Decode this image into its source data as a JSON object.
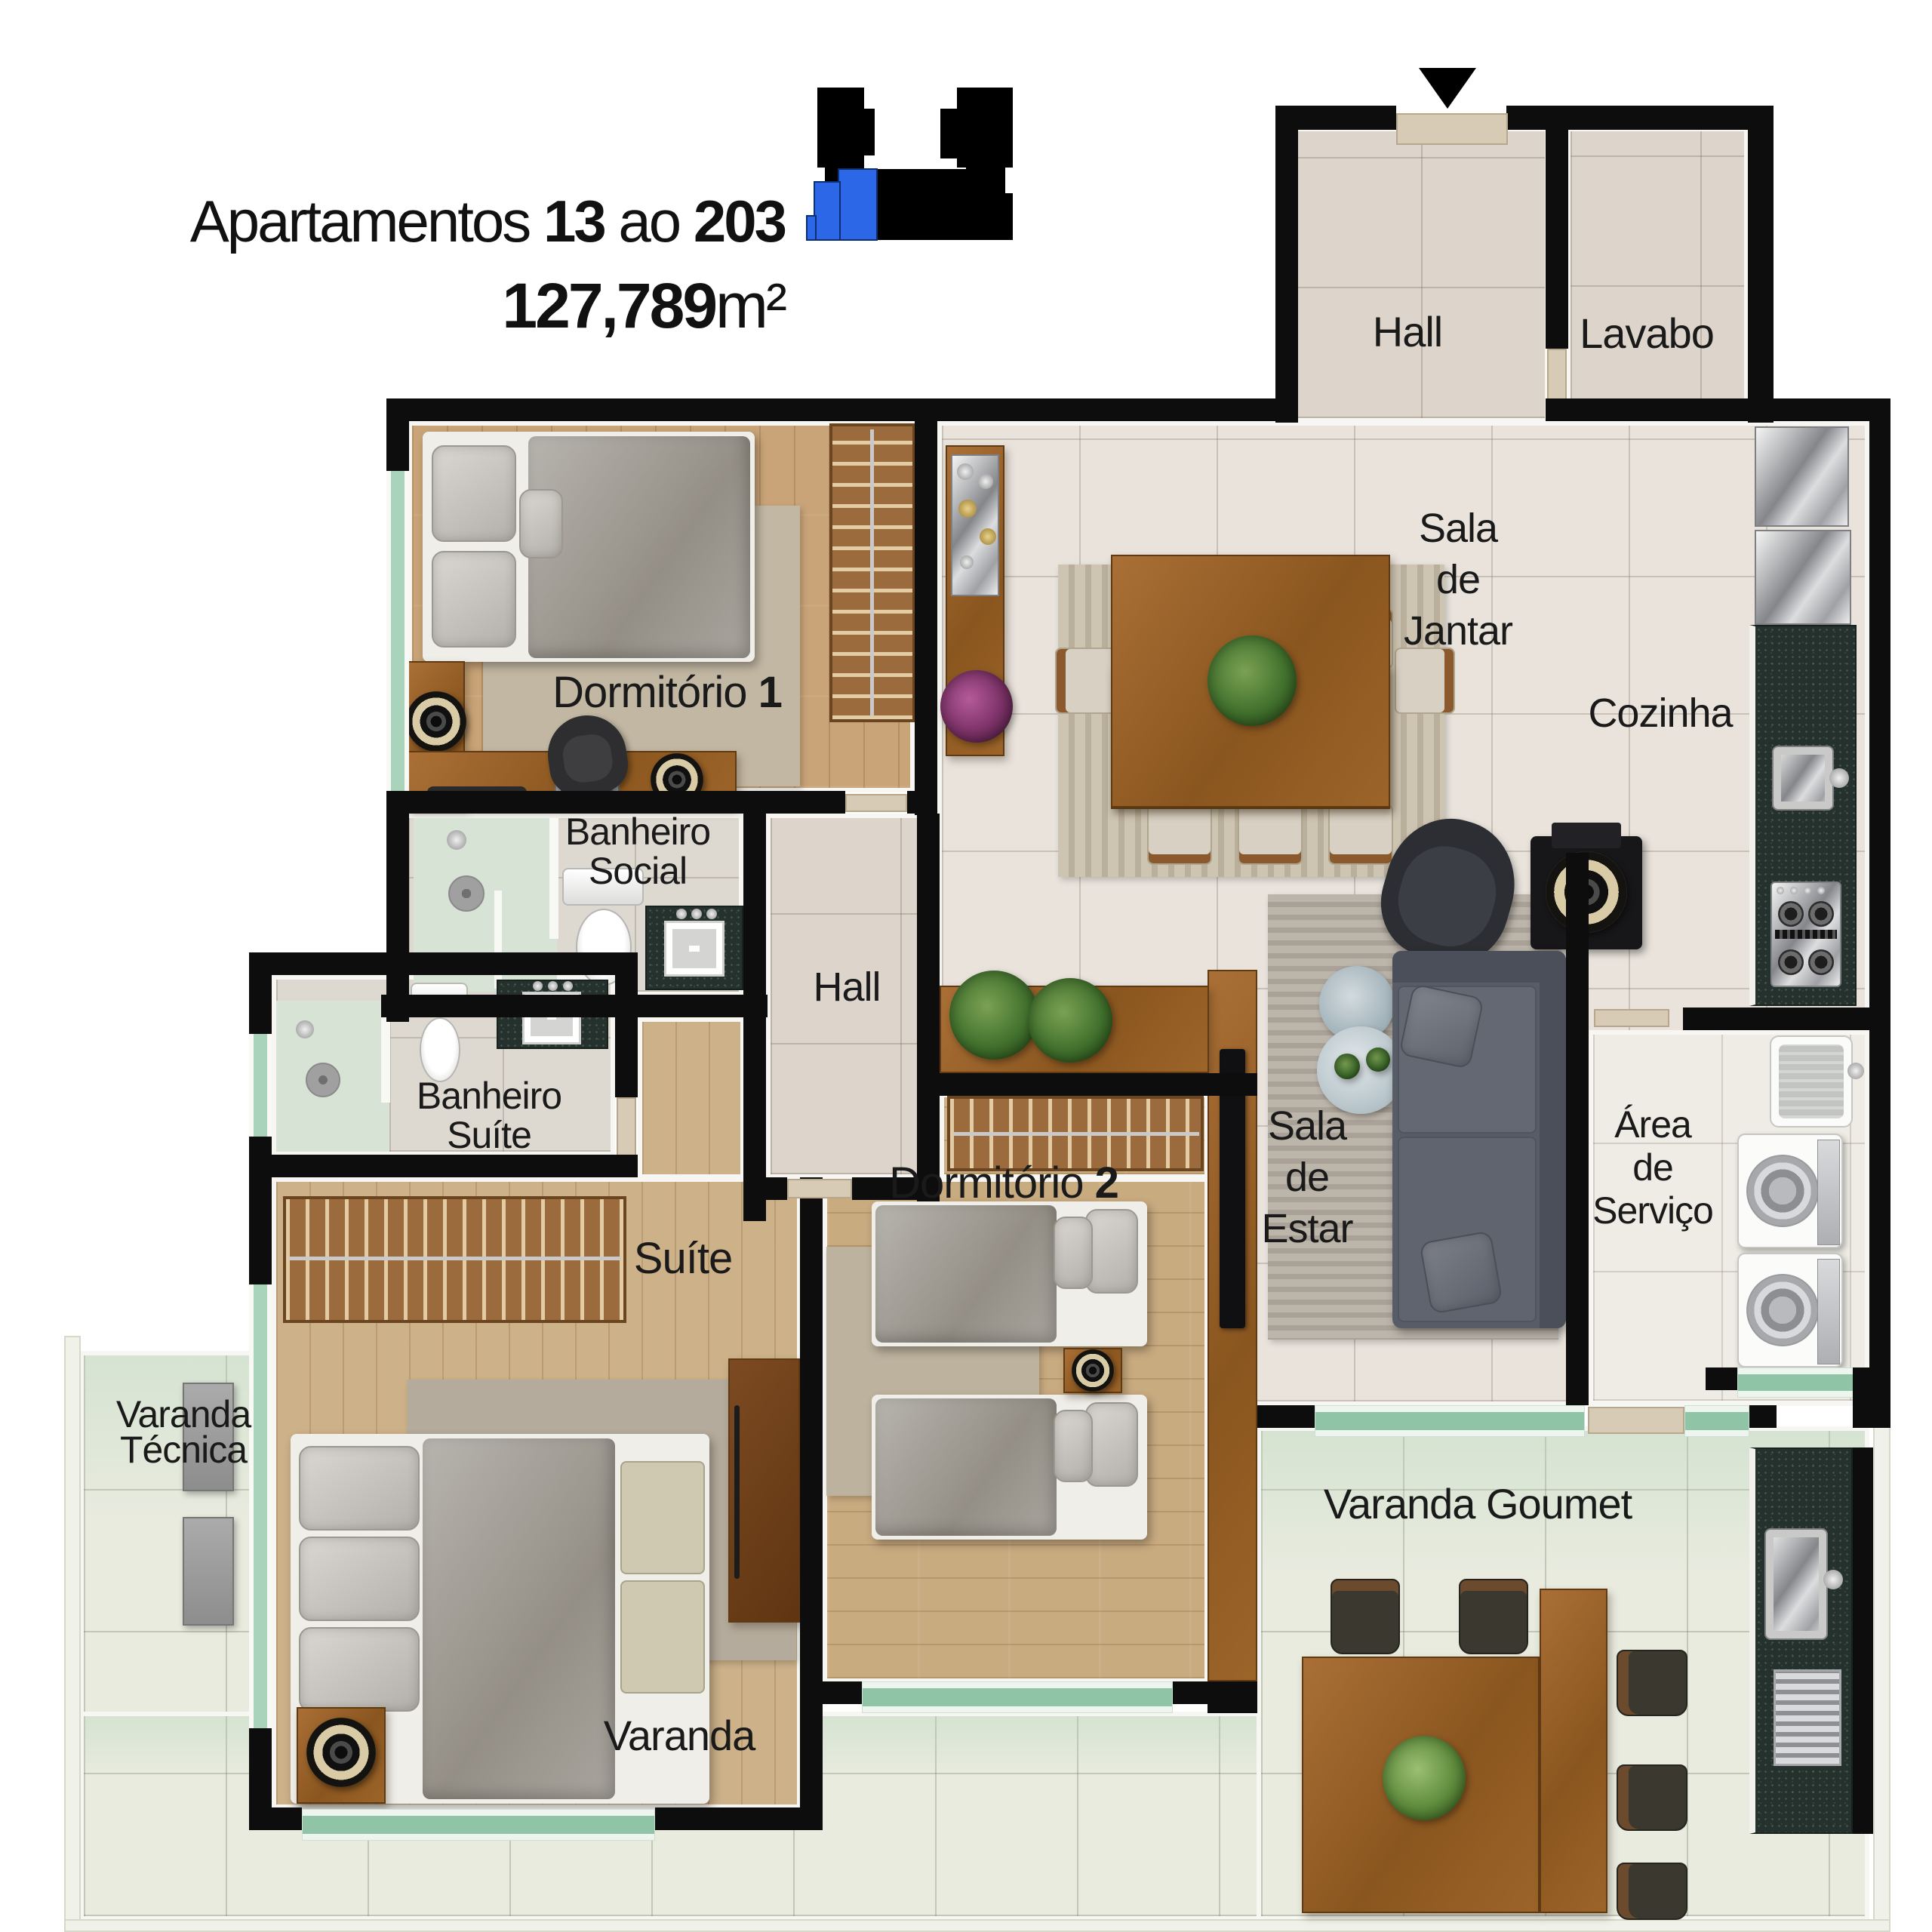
{
  "header": {
    "title": {
      "prefix": "Apartamentos",
      "range_start": "13",
      "conjunction": "ao",
      "range_end": "203"
    },
    "area": {
      "value": "127,789",
      "unit": "m²"
    }
  },
  "keyplan": {
    "description": "building footprint with highlighted unit",
    "highlight_color": "#2b67e6",
    "building_color": "#000000"
  },
  "rooms": {
    "hall_entry": {
      "label": "Hall"
    },
    "lavabo": {
      "label": "Lavabo"
    },
    "sala_de_jantar": {
      "lines": [
        "Sala",
        "de",
        "Jantar"
      ]
    },
    "cozinha": {
      "label": "Cozinha"
    },
    "dormitorio1": {
      "prefix": "Dormitório ",
      "number": "1"
    },
    "banheiro_social": {
      "lines": [
        "Banheiro",
        "Social"
      ]
    },
    "hall_interno": {
      "label": "Hall"
    },
    "banheiro_suite": {
      "lines": [
        "Banheiro",
        "Suíte"
      ]
    },
    "suite": {
      "label": "Suíte"
    },
    "dormitorio2": {
      "prefix": "Dormitório ",
      "number": "2"
    },
    "sala_de_estar": {
      "lines": [
        "Sala",
        "de",
        "Estar"
      ]
    },
    "area_de_servico": {
      "lines": [
        "Área",
        "de",
        "Serviço"
      ]
    },
    "varanda_tecnica": {
      "lines": [
        "Varanda",
        "Técnica"
      ]
    },
    "varanda_goumet": {
      "label": "Varanda Goumet"
    },
    "varanda": {
      "label": "Varanda"
    }
  },
  "colors": {
    "wall": "#0d0d0d",
    "tile_floor": "#e9e3dc",
    "wood_floor": "#c9a478",
    "granite": "#24312c",
    "glass_window": "#a9d3ba",
    "varanda_floor": "#e9ebdf"
  }
}
